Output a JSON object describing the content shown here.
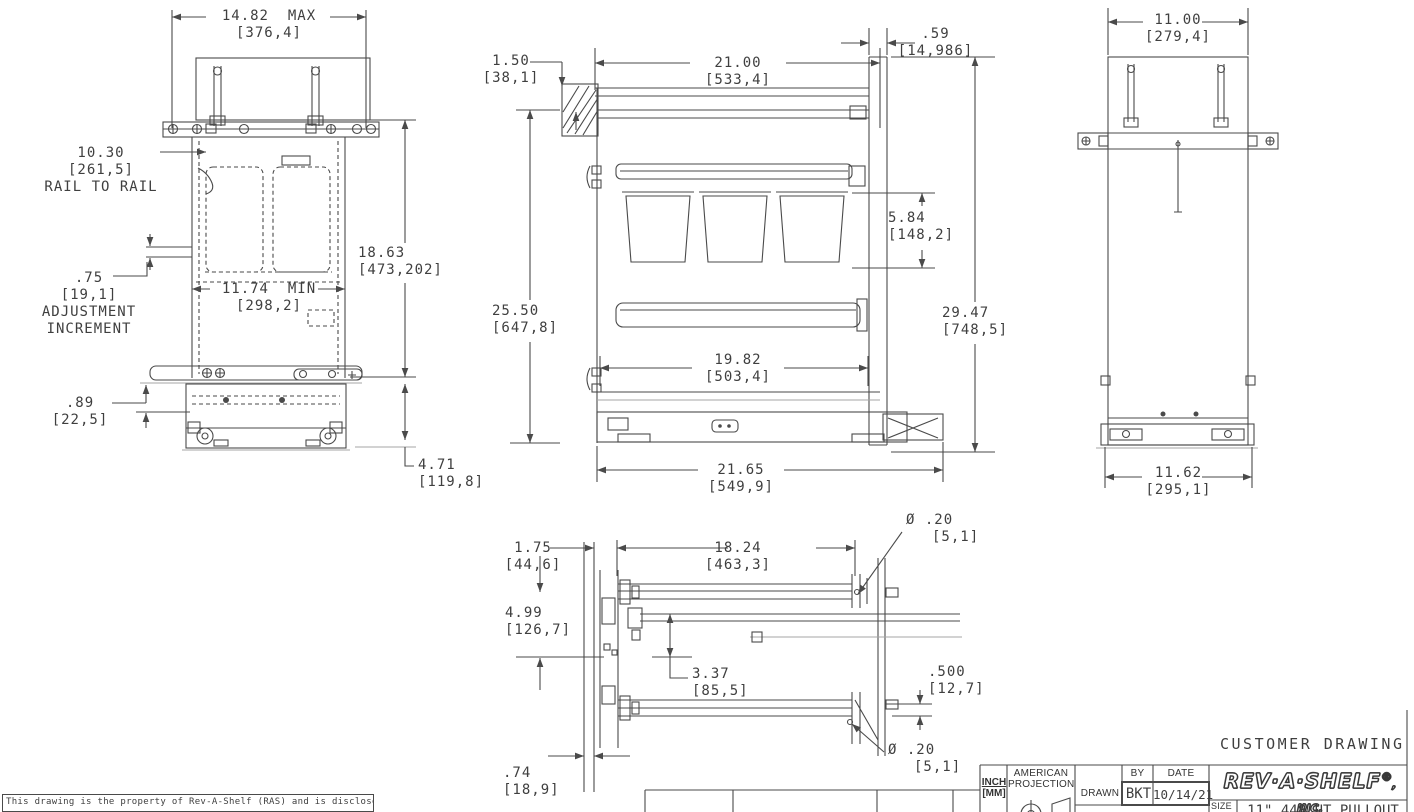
{
  "labels": {
    "customer_drawing": "CUSTOMER DRAWING",
    "disclaimer": "This drawing is the property of Rev-A-Shelf (RAS) and is disclosed"
  },
  "title_block": {
    "projection_line1": "AMERICAN",
    "projection_line2": "PROJECTION",
    "units_inch": "INCH",
    "units_mm": "[MM]",
    "drawn_label": "DRAWN",
    "by_label": "BY",
    "date_label": "DATE",
    "drawn_by": "BKT",
    "date": "10/14/21",
    "size_label": "SIZE",
    "size": "B",
    "company": "REV·A·SHELF",
    "company_reg": "®",
    "company_inc": ", INC.",
    "drawing_title": "11\" 448 UT PULLOUT"
  },
  "dims": {
    "front_width": {
      "l1": "14.82  MAX",
      "l2": "[376,4]"
    },
    "rail_to_rail": {
      "l1": "10.30",
      "l2": "[261,5]",
      "l3": "RAIL TO RAIL"
    },
    "front_height": {
      "l1": "18.63",
      "l2": "[473,202]"
    },
    "adjustment": {
      "l1": ".75",
      "l2": "[19,1]",
      "l3": "ADJUSTMENT",
      "l4": "INCREMENT"
    },
    "min_width": {
      "l1": "11.74  MIN",
      "l2": "[298,2]"
    },
    "slide_height": {
      "l1": ".89",
      "l2": "[22,5]"
    },
    "base_height": {
      "l1": "4.71",
      "l2": "[119,8]"
    },
    "top_gap": {
      "l1": "1.50",
      "l2": "[38,1]"
    },
    "depth": {
      "l1": "21.00",
      "l2": "[533,4]"
    },
    "door_thickness": {
      "l1": ".59",
      "l2": "[14,986]"
    },
    "bin_height": {
      "l1": "5.84",
      "l2": "[148,2]"
    },
    "cabinet_height": {
      "l1": "25.50",
      "l2": "[647,8]"
    },
    "overall_height": {
      "l1": "29.47",
      "l2": "[748,5]"
    },
    "shelf_depth": {
      "l1": "19.82",
      "l2": "[503,4]"
    },
    "overall_depth": {
      "l1": "21.65",
      "l2": "[549,9]"
    },
    "side_width": {
      "l1": "11.00",
      "l2": "[279,4]"
    },
    "side_base_width": {
      "l1": "11.62",
      "l2": "[295,1]"
    },
    "plan_front_offset": {
      "l1": "1.75",
      "l2": "[44,6]"
    },
    "plan_slide_length": {
      "l1": "18.24",
      "l2": "[463,3]"
    },
    "plan_hole_front": {
      "l1": "Ø .20",
      "l2": "[5,1]"
    },
    "plan_rail_offset": {
      "l1": "4.99",
      "l2": "[126,7]"
    },
    "plan_inner_offset": {
      "l1": "3.37",
      "l2": "[85,5]"
    },
    "plan_gap": {
      "l1": ".500",
      "l2": "[12,7]"
    },
    "plan_hole_rear": {
      "l1": "Ø .20",
      "l2": "[5,1]"
    },
    "plan_rear_offset": {
      "l1": ".74",
      "l2": "[18,9]"
    }
  }
}
